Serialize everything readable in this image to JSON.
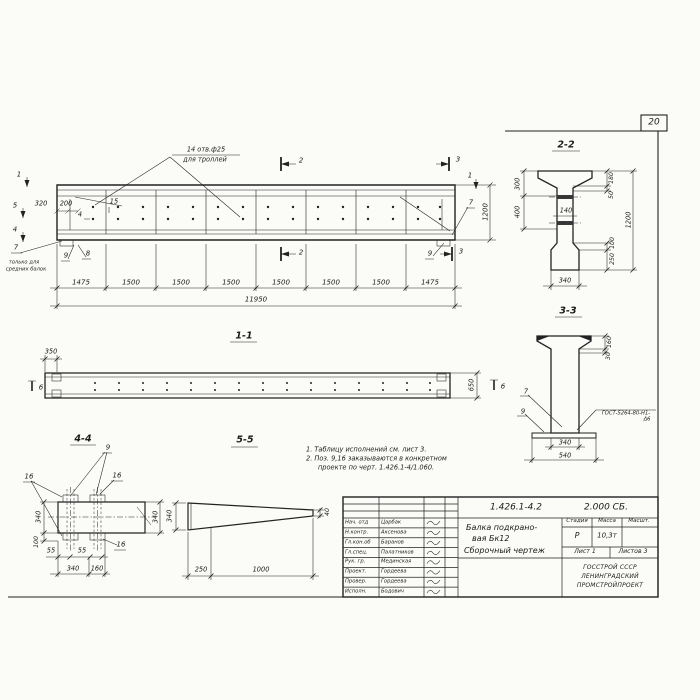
{
  "page": {
    "number": "20"
  },
  "main_view": {
    "callout_line1": "14 отв.ф25",
    "callout_line2": "для троллей",
    "marker_1": "1",
    "marker_5": "5",
    "marker_4": "4",
    "marker_2": "2",
    "marker_3": "3",
    "pos_4": "4",
    "pos_15": "15",
    "pos_7": "7",
    "pos_8": "8",
    "pos_9": "9",
    "note_line1": "только для",
    "note_line2": "средних балок",
    "dim_320": "320",
    "dim_200": "200",
    "dim_1200": "1200",
    "segments": [
      "1475",
      "1500",
      "1500",
      "1500",
      "1500",
      "1500",
      "1500",
      "1475"
    ],
    "dim_total": "11950"
  },
  "section_2_2": {
    "title": "2-2",
    "dim_300": "300",
    "dim_400": "400",
    "dim_140": "140",
    "dim_180": "180",
    "dim_50": "50",
    "dim_100": "100",
    "dim_250": "250",
    "dim_1200": "1200",
    "dim_340": "340"
  },
  "section_3_3": {
    "title": "3-3",
    "dim_160": "160",
    "dim_30": "30",
    "dim_340": "340",
    "dim_540": "540",
    "pos_7": "7",
    "pos_9": "9",
    "weld_line1": "ГОСТ-5264-80-Н1-",
    "weld_line2": "Δ6"
  },
  "section_1_1": {
    "title": "1-1",
    "dim_350": "350",
    "dim_650": "650",
    "marker_6": "6"
  },
  "section_4_4": {
    "title": "4-4",
    "pos_9": "9",
    "pos_16": "16",
    "dim_340_left": "340",
    "dim_100": "100",
    "dim_340_right": "340",
    "dim_55": "55",
    "dim_340_bottom": "340",
    "dim_160": "160"
  },
  "section_5_5": {
    "title": "5-5",
    "dim_340": "340",
    "dim_250": "250",
    "dim_1000": "1000",
    "dim_40": "40"
  },
  "notes": {
    "line1": "1. Таблицу исполнений см. лист 3.",
    "line2": "2. Поз. 9,16 заказываются в конкретном",
    "line3": "проекте по черт. 1.426.1-4/1.060."
  },
  "title_block": {
    "doc_number": "1.426.1-4.2",
    "doc_code": "2.000 СБ.",
    "title_line1": "Балка подкрано-",
    "title_line2": "вая Бк12",
    "title_line3": "Сборочный чертеж",
    "col_stage": "Стадия",
    "col_mass": "Масса",
    "col_scale": "Масшт.",
    "stage": "Р",
    "mass": "10,3т",
    "sheet": "Лист 1",
    "sheets": "Листов 3",
    "org_line1": "ГОССТРОЙ СССР",
    "org_line2": "ЛЕНИНГРАДСКИЙ",
    "org_line3": "ПРОМСТРОЙПРОЕКТ",
    "rows": [
      {
        "role": "Нач. отд",
        "name": "Царбак"
      },
      {
        "role": "Н.контр.",
        "name": "Аксенова"
      },
      {
        "role": "Гл.кон.об",
        "name": "Баранов"
      },
      {
        "role": "Гл.спец.",
        "name": "Палатников"
      },
      {
        "role": "Рук. гр.",
        "name": "Мединская"
      },
      {
        "role": "Проект.",
        "name": "Гордеева"
      },
      {
        "role": "Провер.",
        "name": "Гордеева"
      },
      {
        "role": "Исполн.",
        "name": "Бодович"
      }
    ]
  }
}
